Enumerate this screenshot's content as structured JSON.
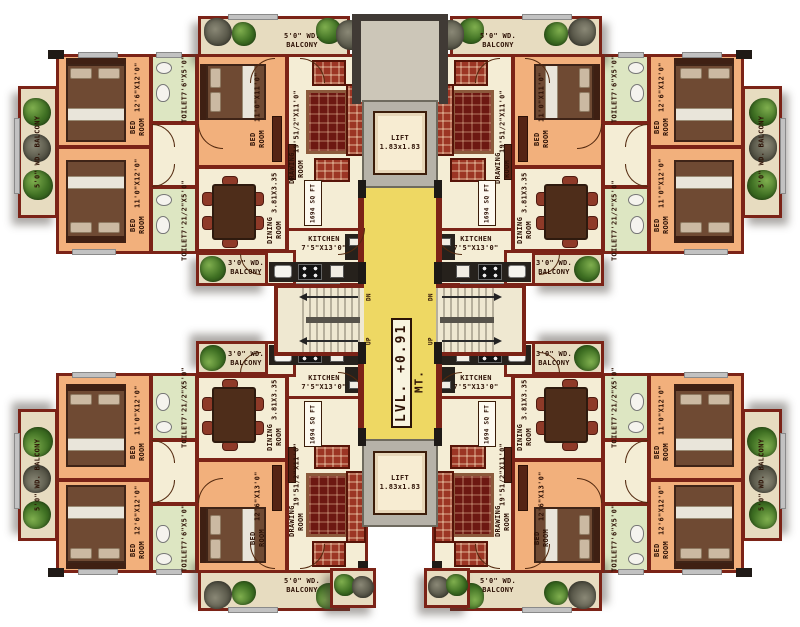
{
  "plan": {
    "level": {
      "value": "LVL. +0.91",
      "unit": "MT."
    },
    "lift": {
      "name": "LIFT",
      "dims": "1.83x1.83"
    },
    "stairs": {
      "up": "UP",
      "down": "DN"
    },
    "unit": {
      "area": "1694 SQ FT",
      "drawing_room": {
        "name": "DRAWING ROOM",
        "dims": "19'51/2\"X11'0\""
      },
      "dining_room": {
        "name": "DINING ROOM",
        "dims": "3.81X3.35"
      },
      "kitchen": {
        "name": "KITCHEN",
        "dims": "7'5\"X13'0\""
      },
      "bed_corner_outer": {
        "name": "BED ROOM",
        "dims": "12'6\"X12'0\""
      },
      "bed_corner_inner": {
        "name": "BED ROOM",
        "dims": "11'0\"X12'0\""
      },
      "bed_center_top": {
        "name": "BED ROOM",
        "dims": "11'0\"X11'0\""
      },
      "bed_center_bottom": {
        "name": "BED ROOM",
        "dims": "12'6\"X13'0\""
      },
      "toilet_a": {
        "name": "TOILET",
        "dims": "7'6\"X5'0\""
      },
      "toilet_b": {
        "name": "TOILET",
        "dims": "7'21/2\"X5'0\""
      },
      "side_balcony": "5'0\" WD. BALCONY",
      "top_balcony_l1": "5'0\" WD.",
      "top_balcony_l2": "BALCONY",
      "kitchen_balcony_l1": "3'0\" WD.",
      "kitchen_balcony_l2": "BALCONY"
    },
    "colors": {
      "wall": "#7b2317",
      "bedroom_floor": "#f2b07c",
      "living_floor": "#f4edd5",
      "toilet_floor": "#dde6c2",
      "balcony_floor": "#e7dcc0",
      "corridor": "#eed863"
    }
  }
}
